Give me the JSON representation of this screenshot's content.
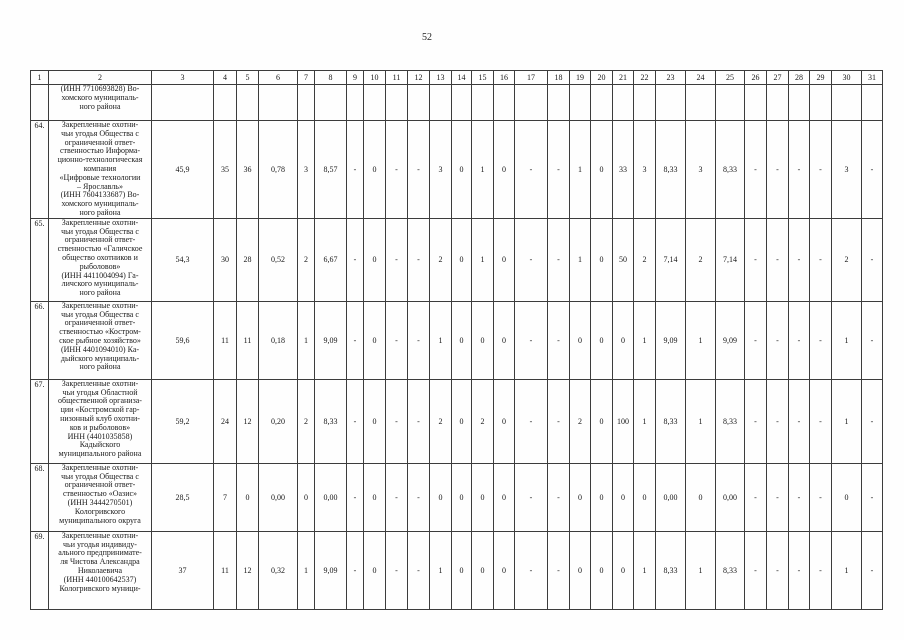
{
  "page_number": "52",
  "table": {
    "headers": [
      "1",
      "2",
      "3",
      "4",
      "5",
      "6",
      "7",
      "8",
      "9",
      "10",
      "11",
      "12",
      "13",
      "14",
      "15",
      "16",
      "17",
      "18",
      "19",
      "20",
      "21",
      "22",
      "23",
      "24",
      "25",
      "26",
      "27",
      "28",
      "29",
      "30",
      "31"
    ],
    "rows": [
      {
        "num": "",
        "name_lines": [
          "(ИНН 7710693828) Во-",
          "хомского муниципаль-",
          "ного района"
        ],
        "values": [
          "",
          "",
          "",
          "",
          "",
          "",
          "",
          "",
          "",
          "",
          "",
          "",
          "",
          "",
          "",
          "",
          "",
          "",
          "",
          "",
          "",
          "",
          "",
          "",
          "",
          "",
          "",
          "",
          ""
        ]
      },
      {
        "num": "64.",
        "name_lines": [
          "Закрепленные охотни-",
          "чьи угодья Общества с",
          "ограниченной ответ-",
          "ственностью Информа-",
          "ционно-технологическая",
          "компания",
          "«Цифровые технологии",
          "– Ярославль»",
          "(ИНН 7604133687) Во-",
          "хомского муниципаль-",
          "ного района"
        ],
        "values": [
          "45,9",
          "35",
          "36",
          "0,78",
          "3",
          "8,57",
          "-",
          "0",
          "-",
          "-",
          "3",
          "0",
          "1",
          "0",
          "-",
          "-",
          "1",
          "0",
          "33",
          "3",
          "8,33",
          "3",
          "8,33",
          "-",
          "-",
          "-",
          "-",
          "3",
          "-"
        ]
      },
      {
        "num": "65.",
        "name_lines": [
          "Закрепленные охотни-",
          "чьи угодья Общества с",
          "ограниченной ответ-",
          "ственностью «Галичское",
          "общество охотников и",
          "рыболовов»",
          "(ИНН 4411004094) Га-",
          "личского муниципаль-",
          "ного района"
        ],
        "values": [
          "54,3",
          "30",
          "28",
          "0,52",
          "2",
          "6,67",
          "-",
          "0",
          "-",
          "-",
          "2",
          "0",
          "1",
          "0",
          "-",
          "-",
          "1",
          "0",
          "50",
          "2",
          "7,14",
          "2",
          "7,14",
          "-",
          "-",
          "-",
          "-",
          "2",
          "-"
        ]
      },
      {
        "num": "66.",
        "name_lines": [
          "Закрепленные охотни-",
          "чьи угодья Общества с",
          "ограниченной ответ-",
          "ственностью «Костром-",
          "ское рыбное хозяйство»",
          "(ИНН 4401094010) Ка-",
          "дыйского муниципаль-",
          "ного района"
        ],
        "values": [
          "59,6",
          "11",
          "11",
          "0,18",
          "1",
          "9,09",
          "-",
          "0",
          "-",
          "-",
          "1",
          "0",
          "0",
          "0",
          "-",
          "-",
          "0",
          "0",
          "0",
          "1",
          "9,09",
          "1",
          "9,09",
          "-",
          "-",
          "-",
          "-",
          "1",
          "-"
        ]
      },
      {
        "num": "67.",
        "name_lines": [
          "Закрепленные охотни-",
          "чьи угодья Областной",
          "общественной организа-",
          "ции «Костромской гар-",
          "низонный клуб охотни-",
          "ков и рыболовов»",
          "ИНН (4401035858)",
          "Кадыйского",
          "муниципального района"
        ],
        "values": [
          "59,2",
          "24",
          "12",
          "0,20",
          "2",
          "8,33",
          "-",
          "0",
          "-",
          "-",
          "2",
          "0",
          "2",
          "0",
          "-",
          "-",
          "2",
          "0",
          "100",
          "1",
          "8,33",
          "1",
          "8,33",
          "-",
          "-",
          "-",
          "-",
          "1",
          "-"
        ]
      },
      {
        "num": "68.",
        "name_lines": [
          "Закрепленные охотни-",
          "чьи угодья Общества с",
          "ограниченной ответ-",
          "ственностью «Оазис»",
          "(ИНН 3444270501)",
          "Кологривского",
          "муниципального округа"
        ],
        "values": [
          "28,5",
          "7",
          "0",
          "0,00",
          "0",
          "0,00",
          "-",
          "0",
          "-",
          "-",
          "0",
          "0",
          "0",
          "0",
          "-",
          "-",
          "0",
          "0",
          "0",
          "0",
          "0,00",
          "0",
          "0,00",
          "-",
          "-",
          "-",
          "-",
          "0",
          "-"
        ]
      },
      {
        "num": "69.",
        "name_lines": [
          "Закрепленные охотни-",
          "чьи угодья индивиду-",
          "ального предпринимате-",
          "ля Чистова Александра",
          "Николаевича",
          "(ИНН 440100642537)",
          "Кологривского муници-"
        ],
        "values": [
          "37",
          "11",
          "12",
          "0,32",
          "1",
          "9,09",
          "-",
          "0",
          "-",
          "-",
          "1",
          "0",
          "0",
          "0",
          "-",
          "-",
          "0",
          "0",
          "0",
          "1",
          "8,33",
          "1",
          "8,33",
          "-",
          "-",
          "-",
          "-",
          "1",
          "-"
        ]
      }
    ]
  }
}
